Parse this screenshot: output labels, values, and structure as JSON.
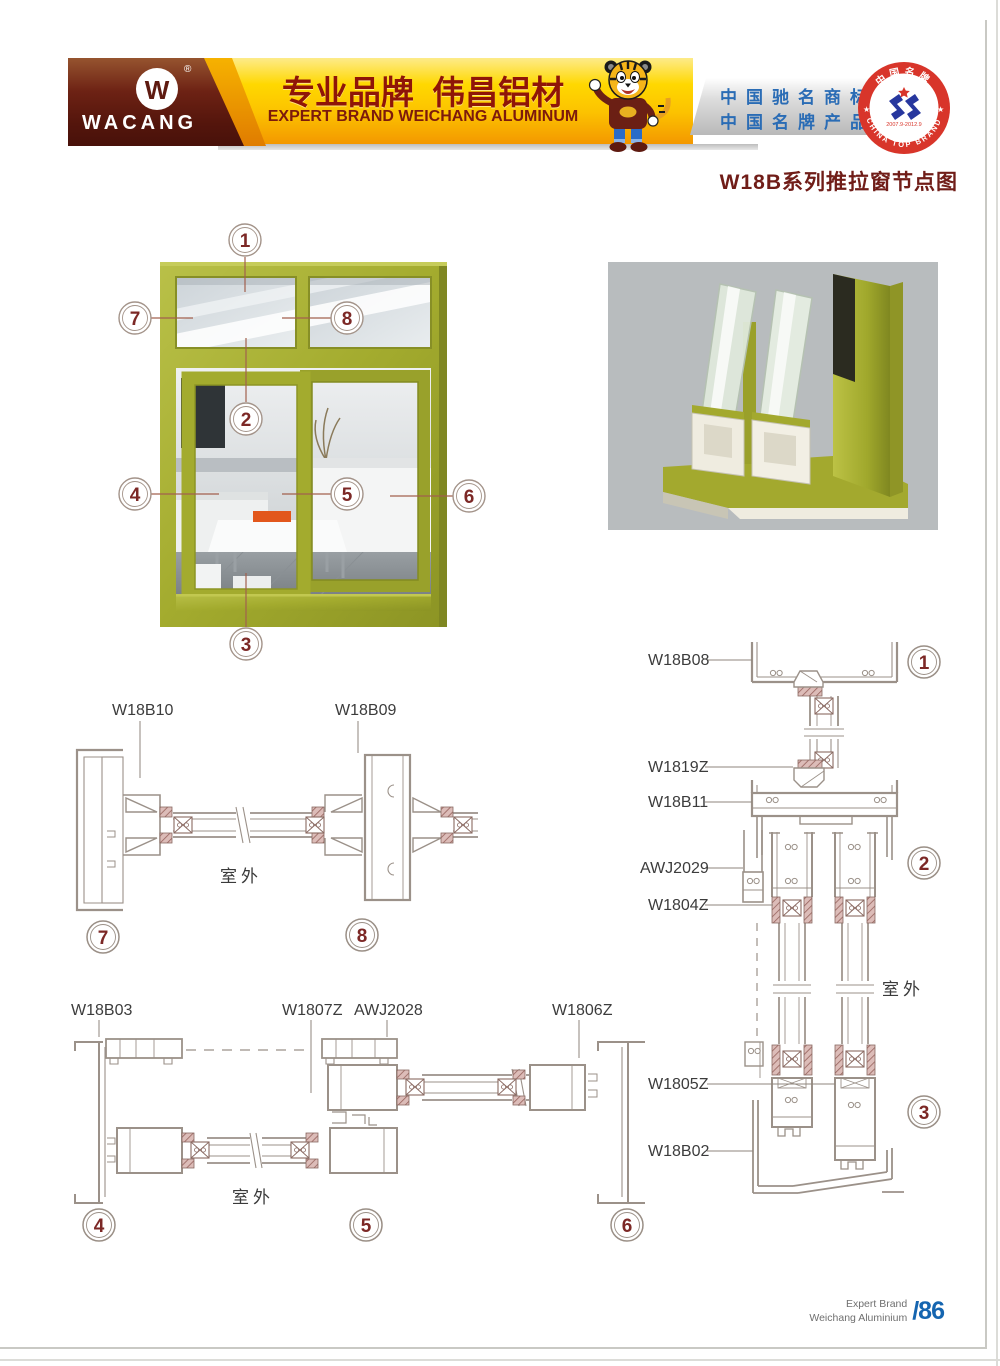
{
  "page": {
    "title": "W18B系列推拉窗节点图",
    "footer": {
      "line1": "Expert Brand",
      "line2": "Weichang Aluminium",
      "page_number": "/86"
    }
  },
  "header": {
    "brand": "WACANG",
    "logo_letter": "W",
    "registered_mark": "®",
    "slogan_cn": "专业品牌  伟昌铝材",
    "slogan_en": "EXPERT BRAND WEICHANG ALUMINUM",
    "claims": {
      "line1": "中国驰名商标",
      "line2": "中国名牌产品"
    },
    "seal": {
      "arc_top": "中国名牌",
      "arc_bottom": "CHINA TOP BRAND",
      "dates": "2007.9-2012.9",
      "star": "★"
    }
  },
  "overview": {
    "callouts": {
      "c1": "1",
      "c2": "2",
      "c3": "3",
      "c4": "4",
      "c5": "5",
      "c6": "6",
      "c7": "7",
      "c8": "8"
    }
  },
  "sections": {
    "top_horizontal": {
      "labels": [
        "W18B10",
        "W18B09"
      ],
      "outdoor": "室外",
      "callouts": [
        "7",
        "8"
      ]
    },
    "bottom_horizontal": {
      "labels": [
        "W18B03",
        "W1807Z",
        "AWJ2028",
        "W1806Z"
      ],
      "outdoor": "室外",
      "callouts": [
        "4",
        "5",
        "6"
      ]
    },
    "right_vertical": {
      "labels": [
        "W18B08",
        "W1819Z",
        "W18B11",
        "AWJ2029",
        "W1804Z",
        "W1805Z",
        "W18B02"
      ],
      "outdoor": "室外",
      "callouts": [
        "1",
        "2",
        "3"
      ]
    }
  },
  "colors": {
    "frame_olive": "#a3ab2e",
    "brand_maroon": "#5e1a10",
    "banner_yellow": "#ffd200",
    "claims_blue": "#2a6cb5",
    "seal_red": "#d8352a",
    "drawing_line": "#9b9189",
    "gasket_hatch": "#a5706e",
    "callout_red": "#7c2826",
    "page_number_blue": "#1565b0"
  }
}
